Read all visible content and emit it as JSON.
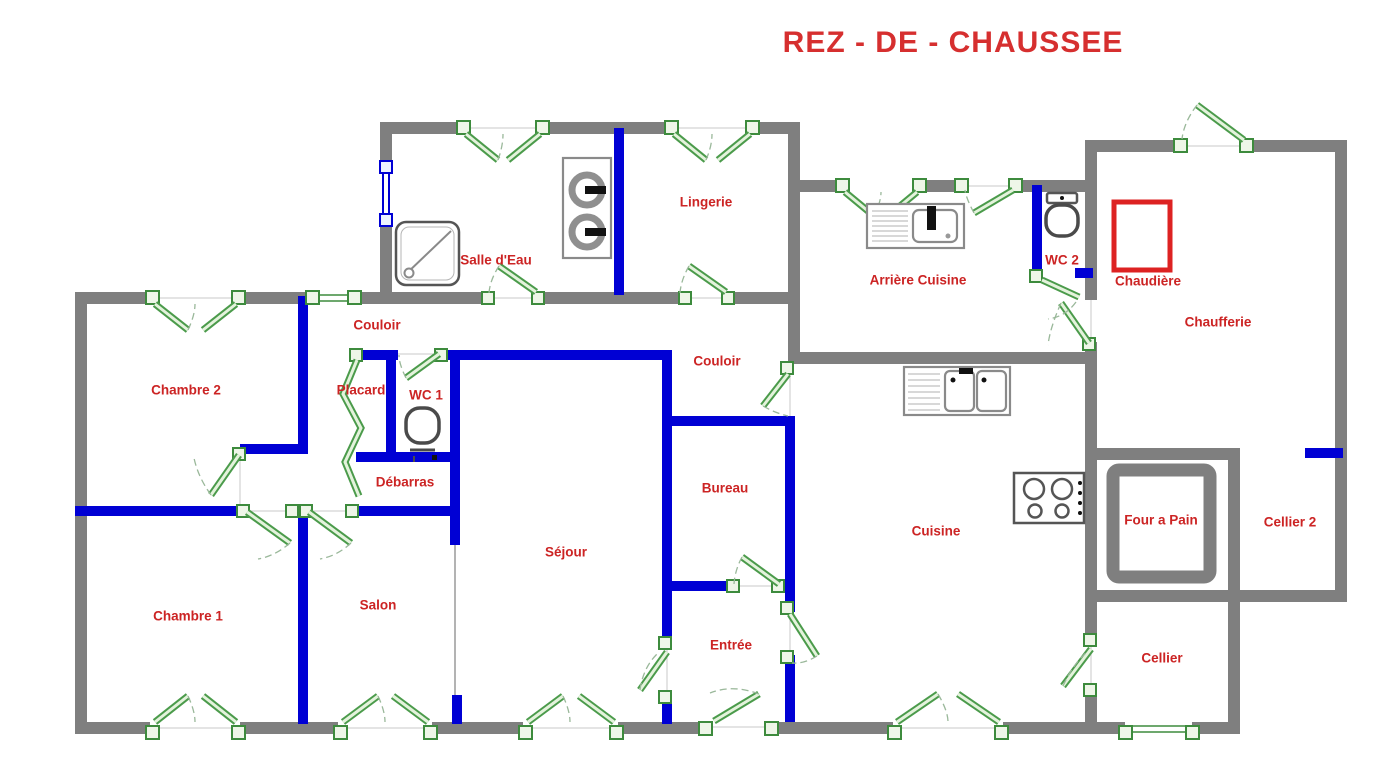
{
  "title": {
    "text": "REZ - DE - CHAUSSEE"
  },
  "colors": {
    "exterior_wall": "#7f7f7f",
    "interior_wall": "#0000d4",
    "label_text": "#cc2424",
    "title_text": "#d62f2f",
    "opening_green": "#3d8b3d",
    "boiler_red": "#dd2222"
  },
  "rooms": [
    {
      "label": "Salle d'Eau"
    },
    {
      "label": "Lingerie"
    },
    {
      "label": "Arrière Cuisine"
    },
    {
      "label": "WC 2"
    },
    {
      "label": "Chaudière"
    },
    {
      "label": "Chaufferie"
    },
    {
      "label": "Couloir"
    },
    {
      "label": "Couloir"
    },
    {
      "label": "Chambre 2"
    },
    {
      "label": "Placard"
    },
    {
      "label": "WC 1"
    },
    {
      "label": "Débarras"
    },
    {
      "label": "Bureau"
    },
    {
      "label": "Cuisine"
    },
    {
      "label": "Four a Pain"
    },
    {
      "label": "Cellier 2"
    },
    {
      "label": "Séjour"
    },
    {
      "label": "Chambre 1"
    },
    {
      "label": "Salon"
    },
    {
      "label": "Entrée"
    },
    {
      "label": "Cellier"
    }
  ],
  "icons": [
    "shower-icon",
    "washing-machines-icon",
    "utility-sink-icon",
    "toilet-icon",
    "kitchen-sink-icon",
    "stove-icon",
    "boiler-icon",
    "bread-oven-icon"
  ]
}
